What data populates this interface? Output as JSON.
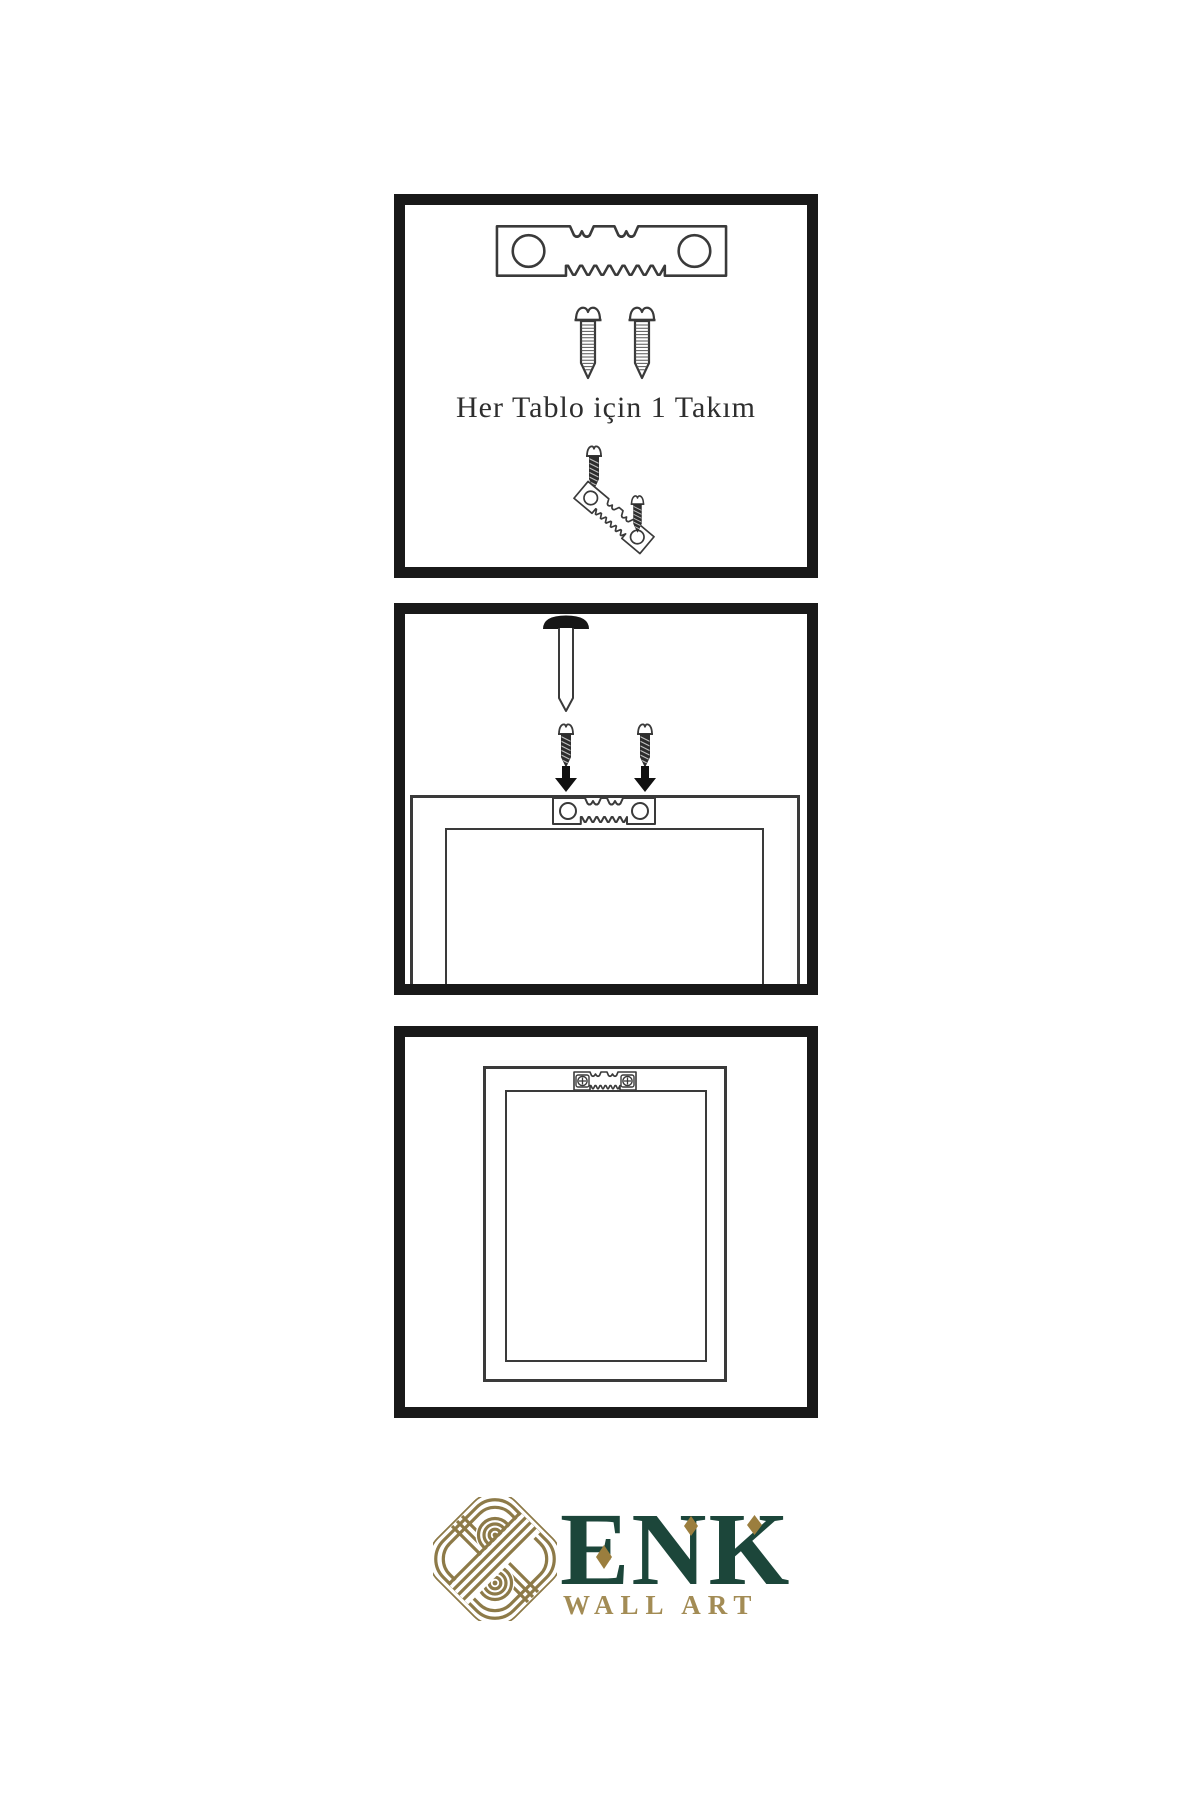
{
  "page": {
    "background": "#ffffff",
    "type": "product-installation-instructions"
  },
  "panel1": {
    "caption": "Her Tablo için 1 Takım"
  },
  "panel2": {
    "caption": ""
  },
  "panel3": {
    "caption": ""
  },
  "logo": {
    "brand": "ENK",
    "subtitle": "WALL ART"
  },
  "colors": {
    "panel_border": "#191919",
    "line_art": "#3a3a3a",
    "dark_screw": "#2d2d2d",
    "brand_green": "#1c463a",
    "knot_gold": "#8d7a48",
    "diamond_gold": "#9b7e3e",
    "subtitle_gold": "#a38c55"
  },
  "icons": {
    "sawtooth_hanger": "sawtooth-hanger-icon",
    "screw": "screw-icon",
    "dark_screw": "dark-screw-icon",
    "nail": "nail-icon",
    "arrow_down": "arrow-down-icon",
    "frame_back": "frame-back-outline",
    "knot": "knot-icon"
  }
}
